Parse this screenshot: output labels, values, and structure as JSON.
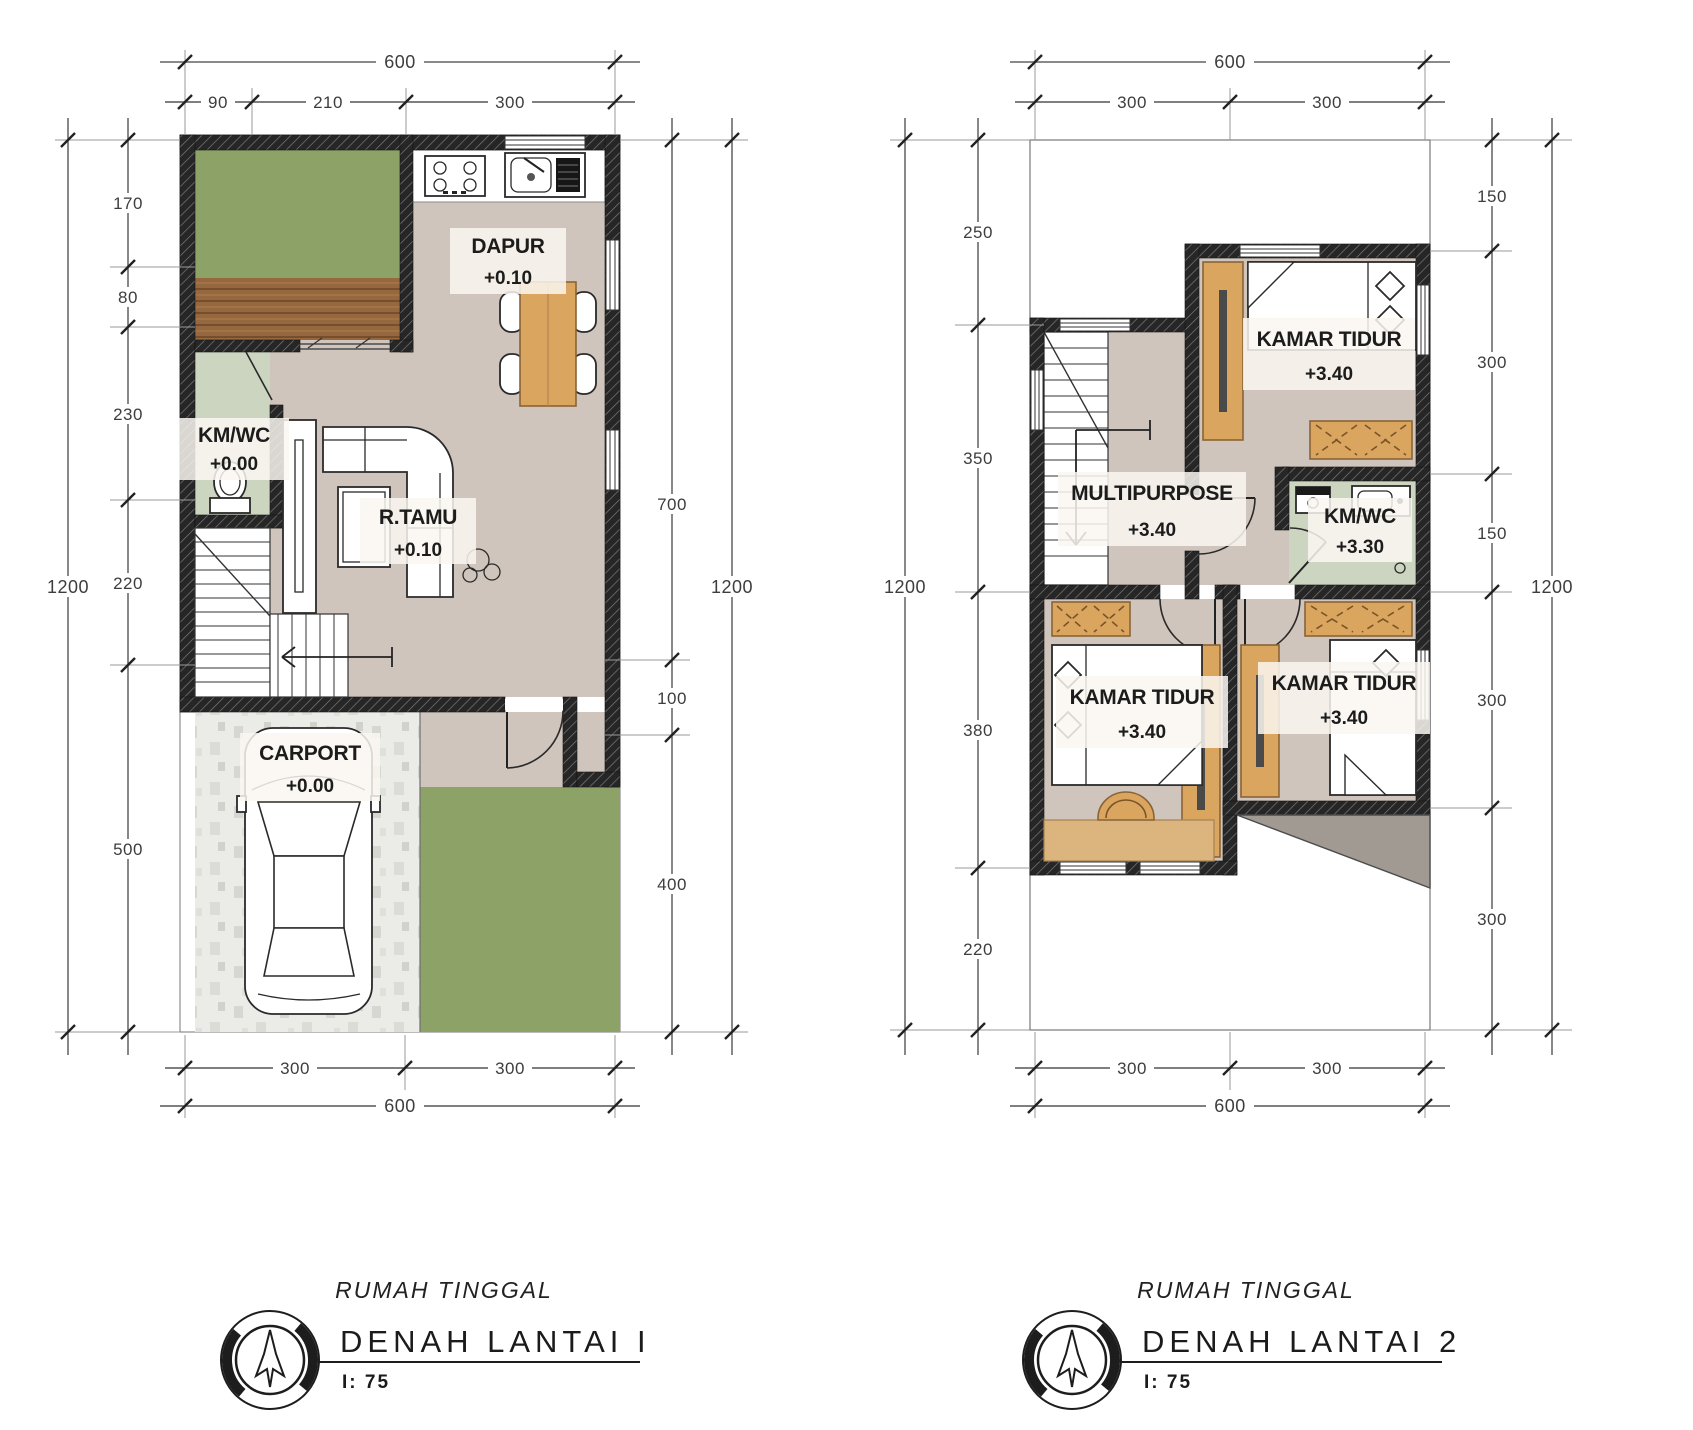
{
  "sheet": {
    "background": "#ffffff",
    "drawing_type": "two-storey house floor plans"
  },
  "colors": {
    "wall": "#262626",
    "floor_beige": "#cfc5bc",
    "floor_sage": "#ccd5c0",
    "grass_green": "#8ca266",
    "wood_deck": "#96683f",
    "furniture_tan": "#d9a55f",
    "carport_tile": "#ebebe8",
    "roof_gray": "#a09a92",
    "dim_text": "#3d3d3d",
    "title_text": "#1b1b1b"
  },
  "plans": [
    {
      "title_sub": "RUMAH TINGGAL",
      "title_main": "DENAH LANTAI I",
      "scale_label": "I:  75",
      "dims": {
        "top_total": "600",
        "top_segs": [
          "90",
          "210",
          "300"
        ],
        "left_total": "1200",
        "left_segs": [
          "170",
          "80",
          "230",
          "220",
          "500"
        ],
        "right_total": "1200",
        "right_segs": [
          "700",
          "100",
          "400"
        ],
        "bottom_segs": [
          "300",
          "300"
        ],
        "bottom_total": "600"
      },
      "rooms": [
        {
          "name": "DAPUR",
          "level": "+0.10"
        },
        {
          "name": "KM/WC",
          "level": "+0.00"
        },
        {
          "name": "R.TAMU",
          "level": "+0.10"
        },
        {
          "name": "CARPORT",
          "level": "+0.00"
        }
      ]
    },
    {
      "title_sub": "RUMAH TINGGAL",
      "title_main": "DENAH LANTAI 2",
      "scale_label": "I:  75",
      "dims": {
        "top_total": "600",
        "top_segs": [
          "300",
          "300"
        ],
        "left_total": "1200",
        "left_segs": [
          "250",
          "350",
          "380",
          "220"
        ],
        "right_total": "1200",
        "right_segs": [
          "150",
          "300",
          "150",
          "300",
          "300"
        ],
        "bottom_segs": [
          "300",
          "300"
        ],
        "bottom_total": "600"
      },
      "rooms": [
        {
          "name": "KAMAR TIDUR",
          "level": "+3.40"
        },
        {
          "name": "MULTIPURPOSE",
          "level": "+3.40"
        },
        {
          "name": "KM/WC",
          "level": "+3.30"
        },
        {
          "name": "KAMAR TIDUR",
          "level": "+3.40"
        },
        {
          "name": "KAMAR TIDUR",
          "level": "+3.40"
        }
      ]
    }
  ]
}
